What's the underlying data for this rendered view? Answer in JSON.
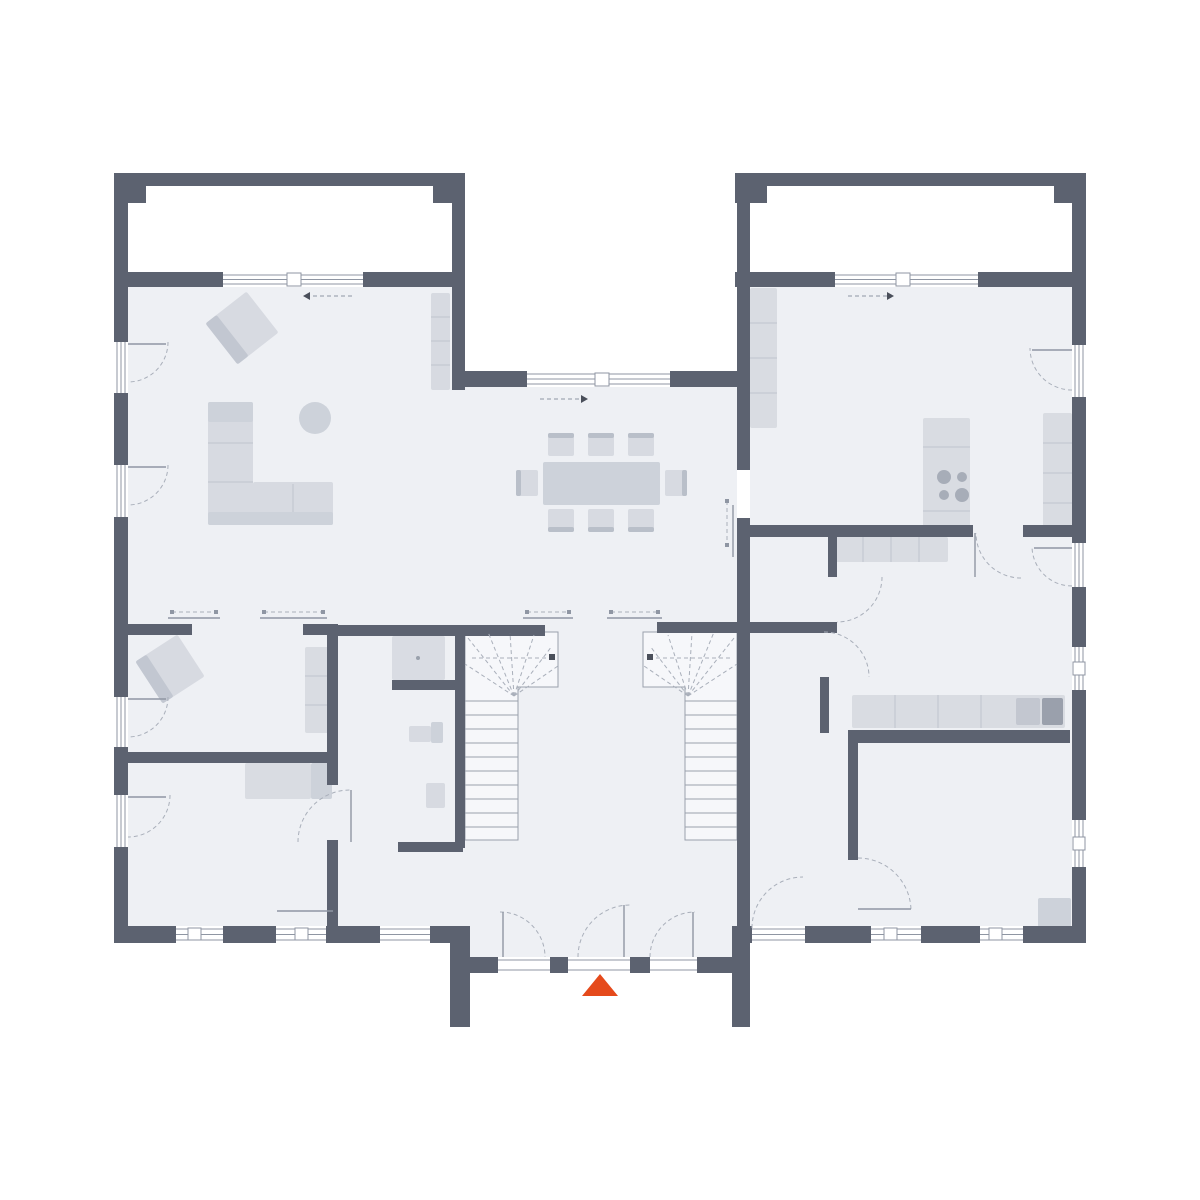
{
  "type": "floor-plan",
  "canvas": {
    "w": 1200,
    "h": 1200
  },
  "colors": {
    "white": "#ffffff",
    "floor": "#eef0f4",
    "stairFloor": "#f6f7fa",
    "wall": "#5c6270",
    "furn": "#d7dae1",
    "furnMid": "#cdd2da",
    "furnDark": "#c2c7d1",
    "furnDeep": "#b9bfc9",
    "counter": "#d9dce2",
    "counterLine": "#bfc4cd",
    "line": "#9aa1ac",
    "dash": "#a9afba",
    "frame": "#8f96a3",
    "burner": "#a7adb8",
    "sinkA": "#c3c7d0",
    "sinkB": "#9aa0ac",
    "shower": "#d9dce3",
    "accent": "#e54a1b"
  },
  "plan": {
    "floors": [
      [
        128,
        287,
        324,
        639,
        "floor",
        "left-wing-floor"
      ],
      [
        452,
        387,
        285,
        539,
        "floor",
        "center-floor"
      ],
      [
        750,
        287,
        322,
        639,
        "floor",
        "right-wing-floor"
      ],
      [
        470,
        926,
        262,
        31,
        "floor",
        "vestibule-floor"
      ],
      [
        128,
        186,
        324,
        86,
        "white",
        "terrace-left"
      ],
      [
        748,
        186,
        325,
        86,
        "white",
        "terrace-right"
      ]
    ],
    "stairs": {
      "outlines": [
        "465,632 558,632 558,687 518,687 518,840 465,840",
        "737,632 643,632 643,687 685,687 685,840 737,840"
      ],
      "treads": [
        [
          465,
          701,
          518,
          701
        ],
        [
          465,
          715,
          518,
          715
        ],
        [
          465,
          729,
          518,
          729
        ],
        [
          465,
          743,
          518,
          743
        ],
        [
          465,
          757,
          518,
          757
        ],
        [
          465,
          771,
          518,
          771
        ],
        [
          465,
          785,
          518,
          785
        ],
        [
          465,
          799,
          518,
          799
        ],
        [
          465,
          813,
          518,
          813
        ],
        [
          465,
          827,
          518,
          827
        ],
        [
          685,
          701,
          737,
          701
        ],
        [
          685,
          715,
          737,
          715
        ],
        [
          685,
          729,
          737,
          729
        ],
        [
          685,
          743,
          737,
          743
        ],
        [
          685,
          757,
          737,
          757
        ],
        [
          685,
          771,
          737,
          771
        ],
        [
          685,
          785,
          737,
          785
        ],
        [
          685,
          799,
          737,
          799
        ],
        [
          685,
          813,
          737,
          813
        ],
        [
          685,
          827,
          737,
          827
        ]
      ],
      "fans": [
        [
          514,
          696,
          465,
          664
        ],
        [
          514,
          696,
          468,
          638
        ],
        [
          514,
          696,
          488,
          632
        ],
        [
          514,
          696,
          510,
          633
        ],
        [
          514,
          696,
          534,
          635
        ],
        [
          514,
          696,
          552,
          646
        ],
        [
          514,
          696,
          558,
          666
        ],
        [
          688,
          696,
          737,
          664
        ],
        [
          688,
          696,
          734,
          638
        ],
        [
          688,
          696,
          714,
          632
        ],
        [
          688,
          696,
          692,
          633
        ],
        [
          688,
          696,
          668,
          635
        ],
        [
          688,
          696,
          650,
          646
        ],
        [
          688,
          696,
          644,
          666
        ]
      ],
      "walklines": [
        [
          472,
          658,
          546,
          658
        ],
        [
          730,
          658,
          656,
          658
        ]
      ],
      "dots": [
        [
          549,
          654
        ],
        [
          647,
          654
        ]
      ]
    },
    "furniture": [
      [
        216,
        302,
        52,
        52,
        "furn",
        "armchair-living",
        -38,
        242,
        328
      ],
      [
        216,
        302,
        14,
        52,
        "furnDark",
        "armchair-living-back",
        -38,
        242,
        328
      ],
      [
        208,
        402,
        45,
        123,
        "furn",
        "sofa-vertical"
      ],
      [
        253,
        482,
        80,
        43,
        "furn",
        "sofa-horizontal"
      ],
      [
        208,
        402,
        45,
        20,
        "furnMid",
        "sofa-cushion"
      ],
      [
        208,
        512,
        125,
        13,
        "furnMid",
        "sofa-edge"
      ],
      [
        431,
        293,
        19,
        97,
        "furn",
        "sideboard-living"
      ],
      [
        543,
        462,
        117,
        43,
        "furnMid",
        "dining-table"
      ],
      [
        548,
        433,
        26,
        23,
        "furn",
        "dining-chair"
      ],
      [
        548,
        433,
        26,
        5,
        "furnDeep",
        "dining-chair-back"
      ],
      [
        588,
        433,
        26,
        23,
        "furn",
        "dining-chair"
      ],
      [
        588,
        433,
        26,
        5,
        "furnDeep",
        "dining-chair-back"
      ],
      [
        628,
        433,
        26,
        23,
        "furn",
        "dining-chair"
      ],
      [
        628,
        433,
        26,
        5,
        "furnDeep",
        "dining-chair-back"
      ],
      [
        548,
        509,
        26,
        23,
        "furn",
        "dining-chair"
      ],
      [
        548,
        527,
        26,
        5,
        "furnDeep",
        "dining-chair-back"
      ],
      [
        588,
        509,
        26,
        23,
        "furn",
        "dining-chair"
      ],
      [
        588,
        527,
        26,
        5,
        "furnDeep",
        "dining-chair-back"
      ],
      [
        628,
        509,
        26,
        23,
        "furn",
        "dining-chair"
      ],
      [
        628,
        527,
        26,
        5,
        "furnDeep",
        "dining-chair-back"
      ],
      [
        516,
        470,
        22,
        26,
        "furn",
        "dining-chair"
      ],
      [
        516,
        470,
        5,
        26,
        "furnDeep",
        "dining-chair-back"
      ],
      [
        665,
        470,
        22,
        26,
        "furn",
        "dining-chair"
      ],
      [
        682,
        470,
        5,
        26,
        "furnDeep",
        "dining-chair-back"
      ],
      [
        750,
        288,
        27,
        140,
        "counter",
        "kitchen-counter-left"
      ],
      [
        923,
        418,
        47,
        115,
        "counter",
        "kitchen-stove-block"
      ],
      [
        1043,
        413,
        29,
        120,
        "counter",
        "kitchen-counter-right"
      ],
      [
        835,
        537,
        113,
        25,
        "counter",
        "utility-sideboard"
      ],
      [
        852,
        695,
        213,
        33,
        "counter",
        "utility-counter"
      ],
      [
        1016,
        698,
        24,
        27,
        "sinkA",
        "utility-sink-drainer"
      ],
      [
        1042,
        698,
        21,
        27,
        "sinkB",
        "utility-sink-basin"
      ],
      [
        145,
        644,
        50,
        50,
        "furn",
        "armchair-office",
        -33,
        170,
        669
      ],
      [
        145,
        644,
        13,
        50,
        "furnDark",
        "armchair-office-back",
        -33,
        170,
        669
      ],
      [
        305,
        647,
        24,
        86,
        "counter",
        "shelf-office"
      ],
      [
        245,
        763,
        66,
        36,
        "counter",
        "desk-room"
      ],
      [
        311,
        763,
        21,
        36,
        "furnMid",
        "desk-return"
      ],
      [
        1038,
        898,
        33,
        29,
        "furnMid",
        "corner-cabinet"
      ],
      [
        392,
        636,
        53,
        44,
        "shower",
        "shower-tray"
      ],
      [
        431,
        722,
        12,
        21,
        "furnMid",
        "toilet-tank"
      ],
      [
        409,
        726,
        22,
        16,
        "furn",
        "toilet-bowl"
      ],
      [
        426,
        783,
        19,
        25,
        "furn",
        "wash-basin"
      ]
    ],
    "circles": [
      [
        315,
        418,
        16,
        "furnMid",
        "side-table-round"
      ],
      [
        944,
        477,
        7,
        "burner",
        "stove-burner"
      ],
      [
        962,
        477,
        5,
        "burner",
        "stove-burner"
      ],
      [
        944,
        495,
        5,
        "burner",
        "stove-burner"
      ],
      [
        962,
        495,
        7,
        "burner",
        "stove-burner"
      ],
      [
        418,
        658,
        2,
        "line",
        "shower-drain"
      ]
    ],
    "divlines": [
      [
        208,
        443,
        253,
        443
      ],
      [
        208,
        482,
        253,
        482
      ],
      [
        293,
        484,
        293,
        512
      ],
      [
        431,
        317,
        450,
        317
      ],
      [
        431,
        341,
        450,
        341
      ],
      [
        431,
        365,
        450,
        365
      ],
      [
        750,
        323,
        777,
        323
      ],
      [
        750,
        358,
        777,
        358
      ],
      [
        750,
        393,
        777,
        393
      ],
      [
        923,
        447,
        970,
        447
      ],
      [
        923,
        511,
        970,
        511
      ],
      [
        1043,
        443,
        1072,
        443
      ],
      [
        1043,
        473,
        1072,
        473
      ],
      [
        1043,
        503,
        1072,
        503
      ],
      [
        863,
        537,
        863,
        562
      ],
      [
        891,
        537,
        891,
        562
      ],
      [
        919,
        537,
        919,
        562
      ],
      [
        895,
        695,
        895,
        728
      ],
      [
        938,
        695,
        938,
        728
      ],
      [
        981,
        695,
        981,
        728
      ],
      [
        305,
        676,
        329,
        676
      ],
      [
        305,
        705,
        329,
        705
      ]
    ],
    "walls": [
      [
        114,
        173,
        14,
        770
      ],
      [
        1072,
        173,
        14,
        770
      ],
      [
        114,
        173,
        351,
        13
      ],
      [
        735,
        173,
        351,
        13
      ],
      [
        114,
        173,
        32,
        30
      ],
      [
        433,
        173,
        32,
        30
      ],
      [
        735,
        173,
        32,
        30
      ],
      [
        1054,
        173,
        32,
        30
      ],
      [
        452,
        186,
        13,
        204
      ],
      [
        737,
        186,
        13,
        284
      ],
      [
        737,
        518,
        13,
        408
      ],
      [
        452,
        371,
        298,
        16
      ],
      [
        114,
        272,
        351,
        15
      ],
      [
        735,
        272,
        351,
        15
      ],
      [
        114,
        926,
        356,
        17
      ],
      [
        732,
        926,
        354,
        17
      ],
      [
        450,
        926,
        20,
        101
      ],
      [
        732,
        926,
        18,
        101
      ],
      [
        465,
        957,
        33,
        16
      ],
      [
        550,
        957,
        18,
        16
      ],
      [
        630,
        957,
        20,
        16
      ],
      [
        697,
        957,
        38,
        16
      ],
      [
        128,
        624,
        64,
        11
      ],
      [
        303,
        624,
        34,
        11
      ],
      [
        330,
        625,
        215,
        11
      ],
      [
        657,
        622,
        93,
        11
      ],
      [
        750,
        622,
        87,
        11
      ],
      [
        327,
        624,
        11,
        161
      ],
      [
        327,
        840,
        11,
        86
      ],
      [
        128,
        752,
        204,
        11
      ],
      [
        392,
        680,
        73,
        10
      ],
      [
        398,
        842,
        65,
        10
      ],
      [
        455,
        625,
        10,
        223
      ],
      [
        750,
        525,
        223,
        12
      ],
      [
        1023,
        525,
        49,
        12
      ],
      [
        828,
        525,
        9,
        52
      ],
      [
        820,
        677,
        9,
        56
      ],
      [
        848,
        730,
        222,
        13
      ],
      [
        848,
        730,
        10,
        130
      ]
    ],
    "windows": [
      [
        114,
        342,
        14,
        51,
        "v"
      ],
      [
        114,
        465,
        14,
        52,
        "v"
      ],
      [
        114,
        697,
        14,
        50,
        "v"
      ],
      [
        114,
        795,
        14,
        52,
        "v"
      ],
      [
        1072,
        345,
        14,
        52,
        "v"
      ],
      [
        1072,
        543,
        14,
        44,
        "v"
      ],
      [
        1072,
        647,
        14,
        43,
        "v"
      ],
      [
        1072,
        820,
        14,
        47,
        "v"
      ],
      [
        176,
        926,
        47,
        17,
        "h"
      ],
      [
        276,
        926,
        50,
        17,
        "h"
      ],
      [
        380,
        926,
        50,
        17,
        "h"
      ],
      [
        752,
        926,
        53,
        17,
        "h"
      ],
      [
        871,
        926,
        50,
        17,
        "h"
      ],
      [
        980,
        926,
        43,
        17,
        "h"
      ],
      [
        223,
        272,
        140,
        15,
        "h"
      ],
      [
        527,
        371,
        143,
        16,
        "h"
      ],
      [
        835,
        272,
        143,
        15,
        "h"
      ]
    ],
    "squares": [
      [
        287,
        273,
        14,
        13
      ],
      [
        595,
        373,
        14,
        13
      ],
      [
        896,
        273,
        14,
        13
      ],
      [
        188,
        928,
        13,
        12
      ],
      [
        295,
        928,
        13,
        12
      ],
      [
        884,
        928,
        13,
        12
      ],
      [
        989,
        928,
        13,
        12
      ],
      [
        1073,
        662,
        12,
        13
      ],
      [
        1073,
        837,
        12,
        13
      ]
    ],
    "framelines": [
      [
        498,
        960,
        550,
        960
      ],
      [
        498,
        970,
        550,
        970
      ],
      [
        568,
        960,
        630,
        960
      ],
      [
        568,
        970,
        630,
        970
      ],
      [
        650,
        960,
        697,
        960
      ],
      [
        650,
        970,
        697,
        970
      ]
    ],
    "sliders": [
      [
        168,
        618,
        220,
        618,
        172,
        612,
        216,
        612
      ],
      [
        260,
        618,
        327,
        618,
        264,
        612,
        323,
        612
      ],
      [
        523,
        618,
        573,
        618,
        527,
        612,
        569,
        612
      ],
      [
        607,
        618,
        662,
        618,
        611,
        612,
        658,
        612
      ],
      [
        733,
        505,
        733,
        557,
        727,
        501,
        727,
        545
      ]
    ],
    "arrows": [
      [
        352,
        296,
        310,
        296
      ],
      [
        540,
        399,
        581,
        399
      ],
      [
        848,
        296,
        887,
        296
      ]
    ],
    "arcs": [
      [
        128,
        342,
        40,
        0,
        90
      ],
      [
        128,
        465,
        40,
        0,
        90
      ],
      [
        128,
        697,
        40,
        0,
        90
      ],
      [
        128,
        795,
        42,
        0,
        90
      ],
      [
        1072,
        348,
        42,
        90,
        180
      ],
      [
        1072,
        546,
        40,
        90,
        180
      ],
      [
        630,
        957,
        52,
        180,
        270
      ],
      [
        500,
        957,
        45,
        270,
        360
      ],
      [
        695,
        957,
        45,
        180,
        270
      ],
      [
        350,
        842,
        52,
        180,
        270
      ],
      [
        1021,
        533,
        45,
        90,
        180
      ],
      [
        837,
        577,
        45,
        0,
        90
      ],
      [
        824,
        677,
        45,
        270,
        360
      ],
      [
        858,
        911,
        53,
        270,
        360
      ],
      [
        803,
        928,
        51,
        180,
        270
      ]
    ],
    "leaves": [
      [
        128,
        344,
        166,
        344
      ],
      [
        128,
        467,
        166,
        467
      ],
      [
        128,
        699,
        166,
        699
      ],
      [
        128,
        797,
        166,
        797
      ],
      [
        1032,
        350,
        1072,
        350
      ],
      [
        1034,
        548,
        1072,
        548
      ],
      [
        624,
        905,
        624,
        957
      ],
      [
        503,
        912,
        503,
        957
      ],
      [
        693,
        912,
        693,
        957
      ],
      [
        351,
        790,
        351,
        842
      ],
      [
        277,
        911,
        333,
        911
      ],
      [
        975,
        533,
        975,
        577
      ],
      [
        858,
        909,
        911,
        909
      ]
    ],
    "entrance": {
      "points": "600,974 582,996 618,996",
      "fill": "accent",
      "name": "entrance-arrow"
    }
  }
}
